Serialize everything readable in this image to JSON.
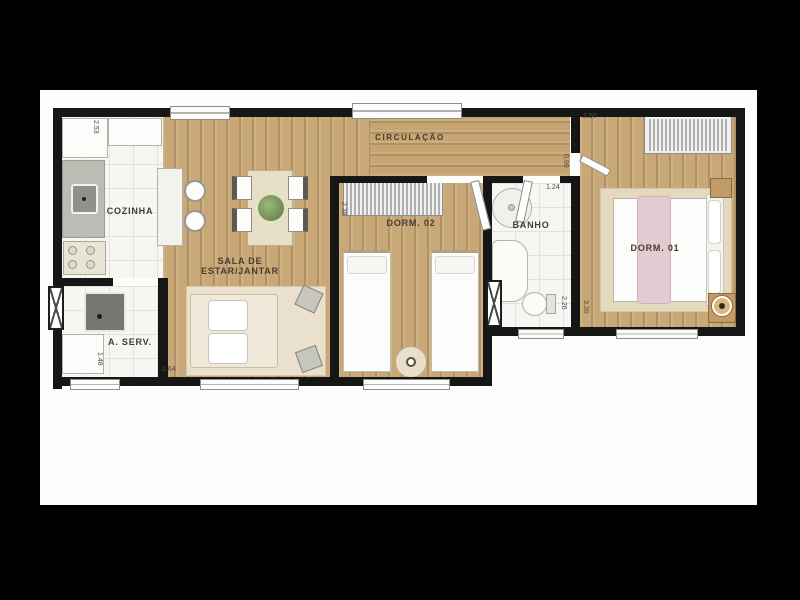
{
  "plan_type": "apartment-floor-plan",
  "colors": {
    "background": "#000000",
    "canvas": "#fdfdfc",
    "wall": "#161616",
    "wood_floor": "#c9a877",
    "tile_floor": "#f6f6f3",
    "bed_runner_pink": "#e2ccd2",
    "label_text": "#453c30"
  },
  "rooms": {
    "cozinha": {
      "label": "COZINHA"
    },
    "aserv": {
      "label": "A. SERV."
    },
    "sala": {
      "label_line1": "SALA DE",
      "label_line2": "ESTAR/JANTAR"
    },
    "circulacao": {
      "label": "CIRCULAÇÃO"
    },
    "dorm02": {
      "label": "DORM. 02"
    },
    "banho": {
      "label": "BANHO"
    },
    "dorm01": {
      "label": "DORM. 01"
    }
  },
  "dimensions": {
    "cozinha_depth": "2.53",
    "dorm01_top_width": "2.50",
    "dorm01_door_width": "0.90",
    "banho_width": "1.24",
    "dorm02_side": "2.38",
    "aserv_height": "1.48",
    "aserv_width": "1.64",
    "banho_height": "2.26",
    "dorm01_height": "3.30"
  }
}
